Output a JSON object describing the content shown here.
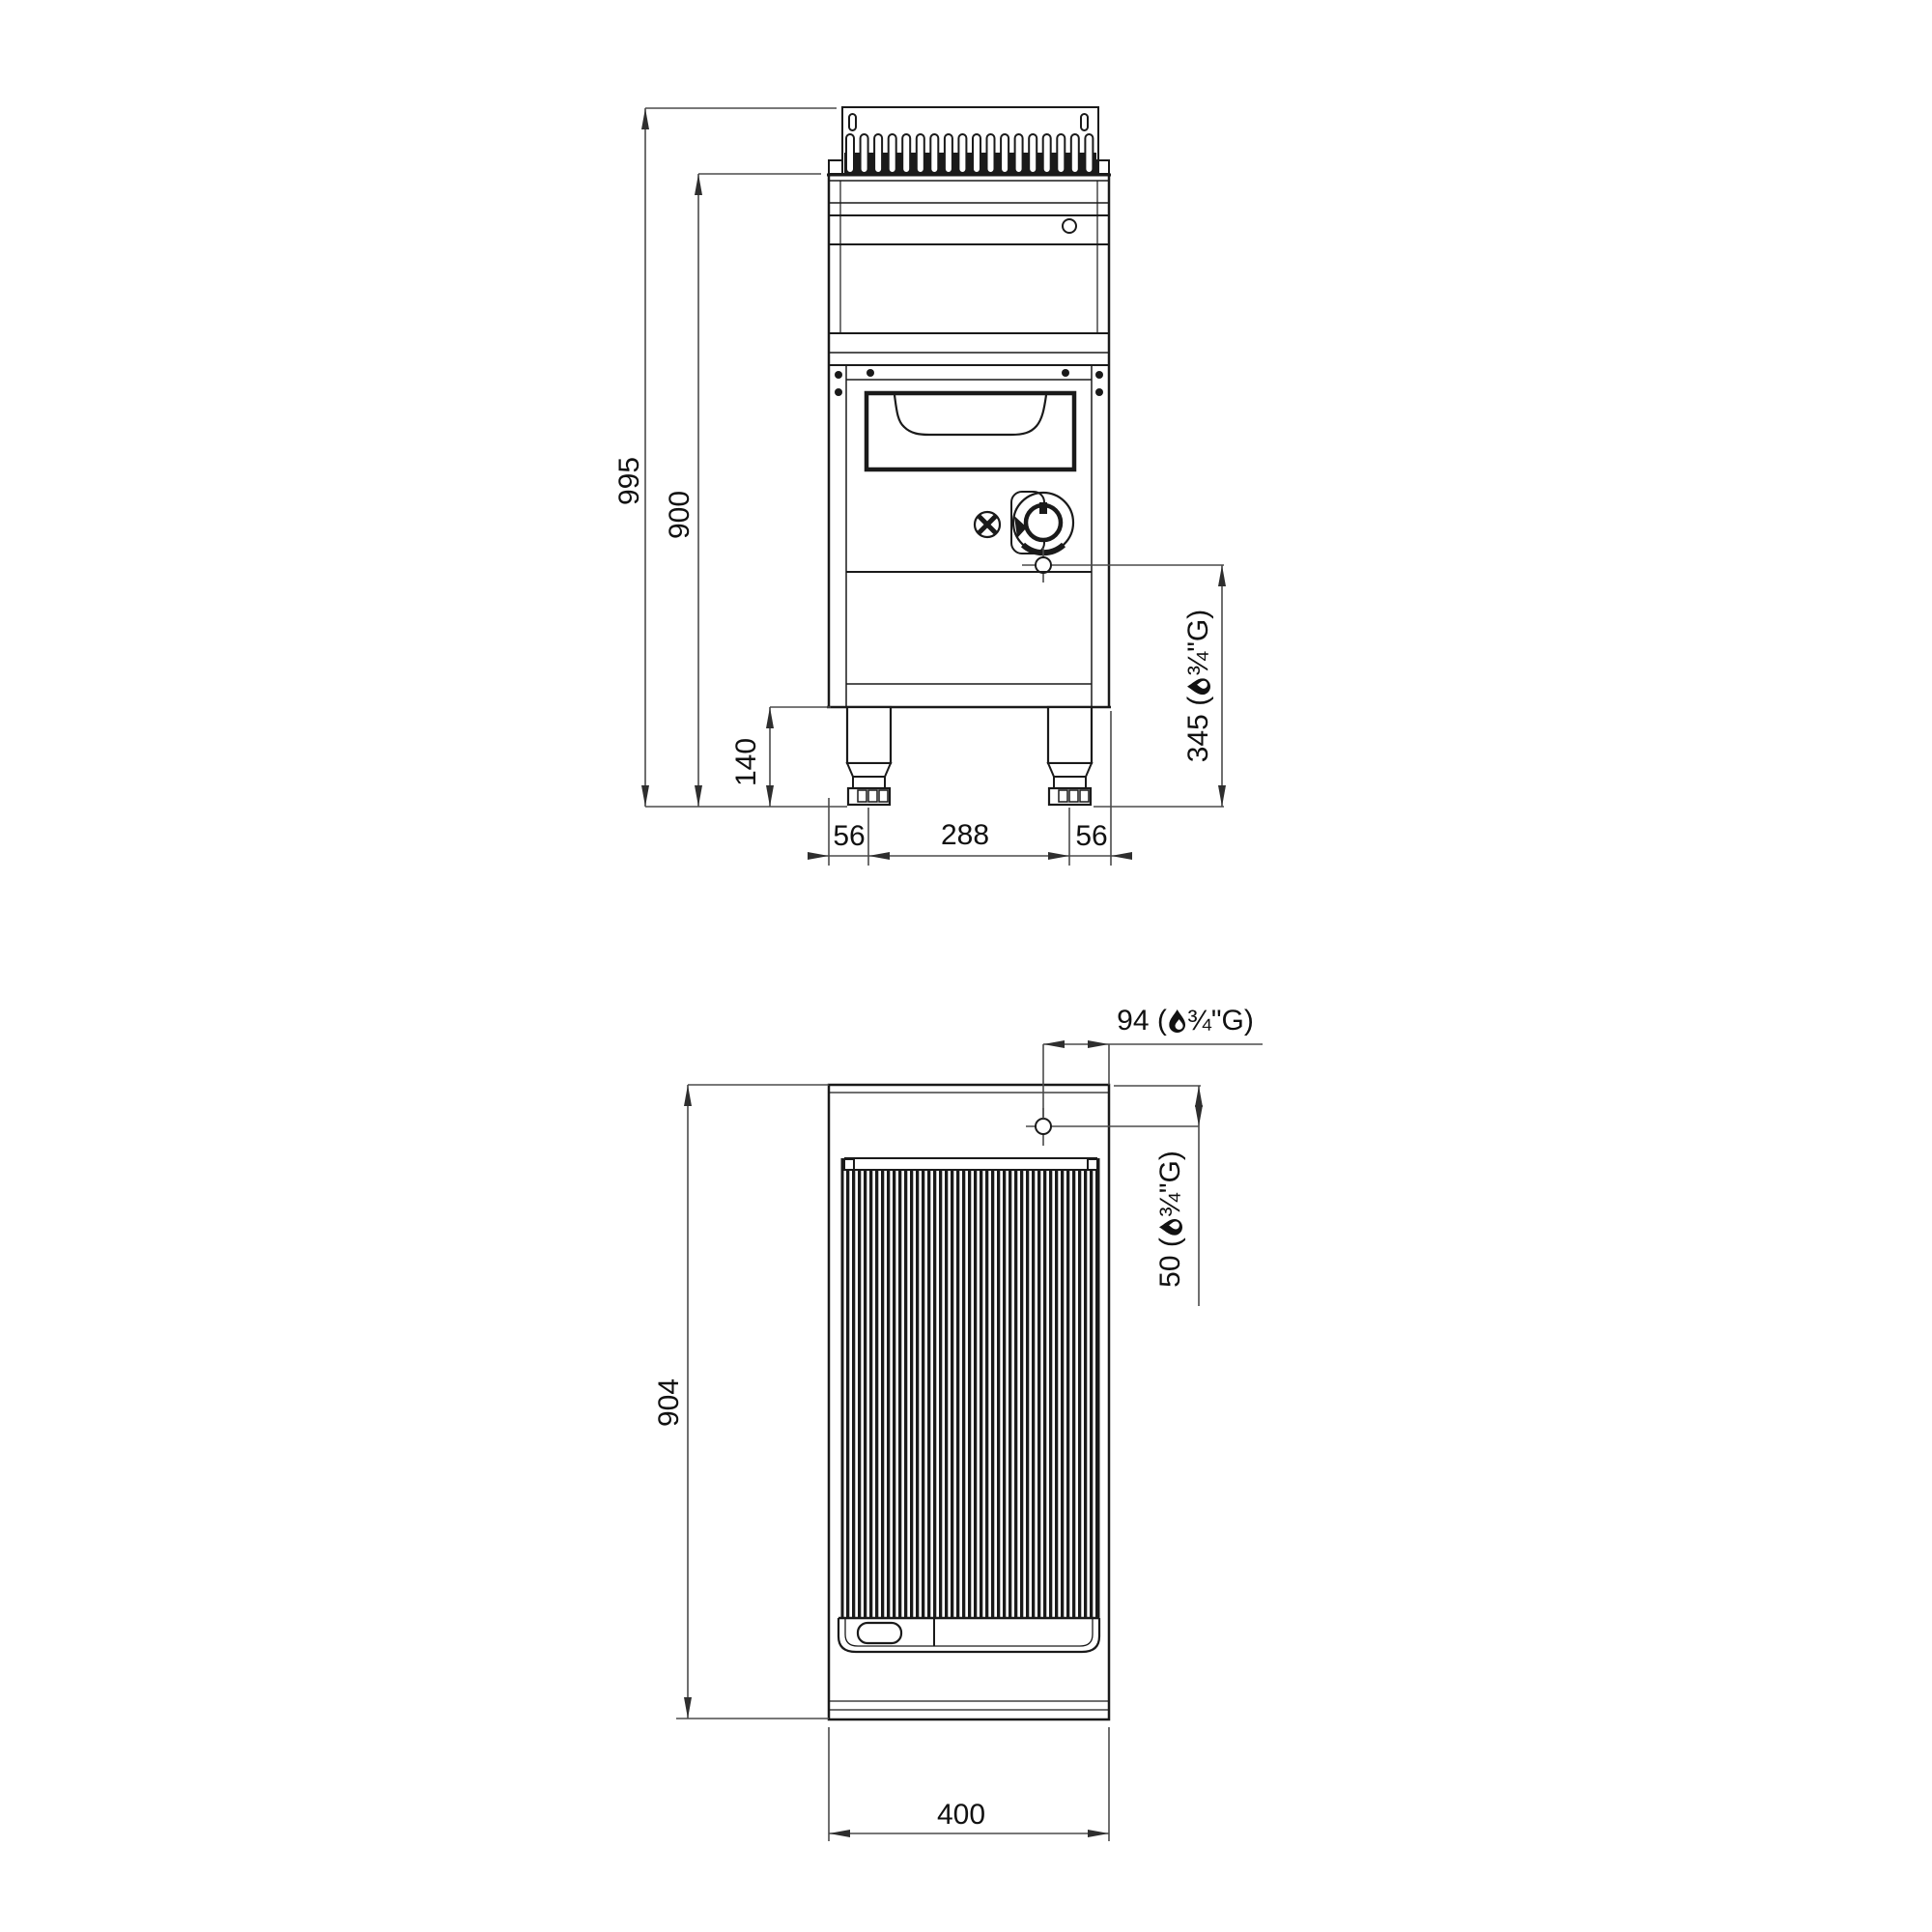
{
  "front_view": {
    "overall_height": "995",
    "body_height": "900",
    "leg_height": "140",
    "foot_offset_left": "56",
    "foot_spacing": "288",
    "foot_offset_right": "56",
    "gas_height": {
      "pre": "345 (",
      "post": "¾\"G)"
    }
  },
  "plan_view": {
    "depth": "904",
    "width": "400",
    "gas_offset_right": {
      "pre": "94 (",
      "post": "¾\"G)"
    },
    "gas_offset_top": {
      "pre": "50 (",
      "post": "¾\"G)"
    }
  },
  "icons": {
    "flame": "gas-flame-icon"
  },
  "colors": {
    "line": "#1a1a1a",
    "dim": "#4b4b4b",
    "background": "#ffffff"
  }
}
